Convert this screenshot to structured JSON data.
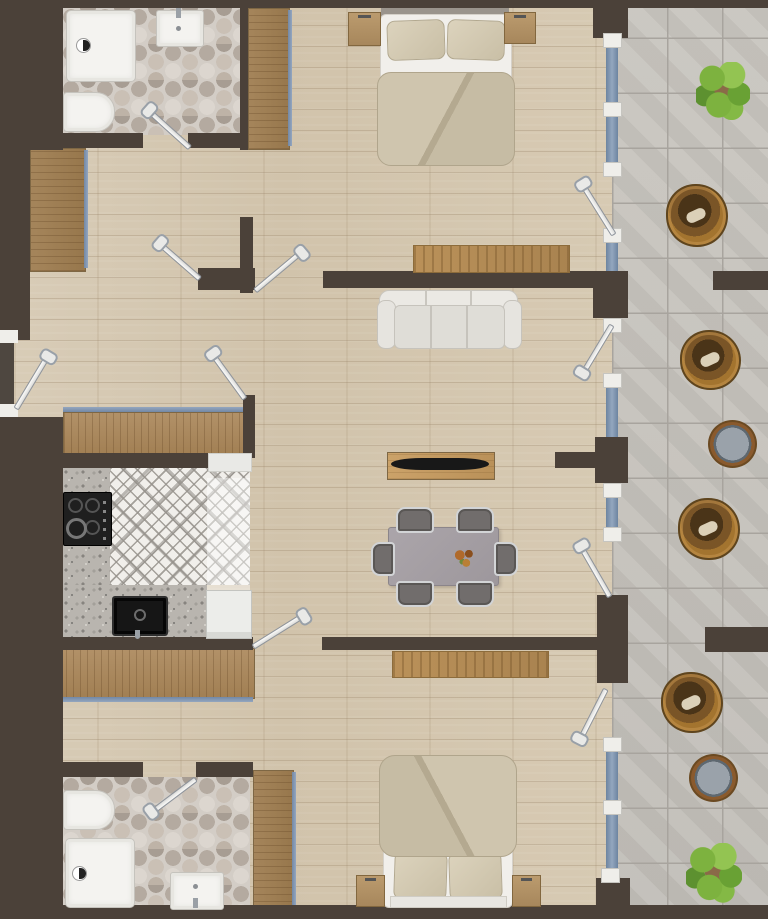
{
  "title": "apartment-floor-plan",
  "palette": {
    "wall": "#4b4139",
    "wood_floor": "#d5c8b2",
    "terrace_tile": "#c5c2bc",
    "bath_hex_tile": "#c9c2ba",
    "kitchen_tile": "#f0eeea",
    "glass": "#7e93ad",
    "frame_white": "#efeeea",
    "wardrobe_wood": "#ab8a5e",
    "rug": "#b38e58",
    "sofa": "#e7e5e0",
    "bed_duvet": "#c7bda6",
    "dining_table": "#a59fa4",
    "wicker_chair": "#9c6f33",
    "plant_green": "#7db23f",
    "counter_granite": "#b9b5af",
    "stove_black": "#1f1f1f"
  },
  "rooms": [
    {
      "id": "bathroom-top",
      "label": "bathroom"
    },
    {
      "id": "bedroom-top",
      "label": "bedroom"
    },
    {
      "id": "dressing",
      "label": "dressing"
    },
    {
      "id": "hallway",
      "label": "hallway"
    },
    {
      "id": "kitchen",
      "label": "kitchen"
    },
    {
      "id": "living-dining",
      "label": "living-dining-room"
    },
    {
      "id": "bedroom-bottom",
      "label": "bedroom"
    },
    {
      "id": "bathroom-bottom",
      "label": "bathroom"
    },
    {
      "id": "terrace",
      "label": "terrace"
    }
  ],
  "furniture_inventory": [
    "double-bed (2)",
    "nightstand (4)",
    "wardrobe (5)",
    "rug (2)",
    "sofa",
    "tv-console",
    "dining-table",
    "dining-chair (6)",
    "stove",
    "kitchen-sink",
    "fridge",
    "dishwasher",
    "shower (2)",
    "toilet (2)",
    "washbasin (2)",
    "wicker-chair (4)",
    "terrace-side-table (2)",
    "plant (3)"
  ],
  "openings": {
    "entrance_doors": 1,
    "interior_doors": 6,
    "terrace_doors": 4,
    "glass_panels": 7
  }
}
